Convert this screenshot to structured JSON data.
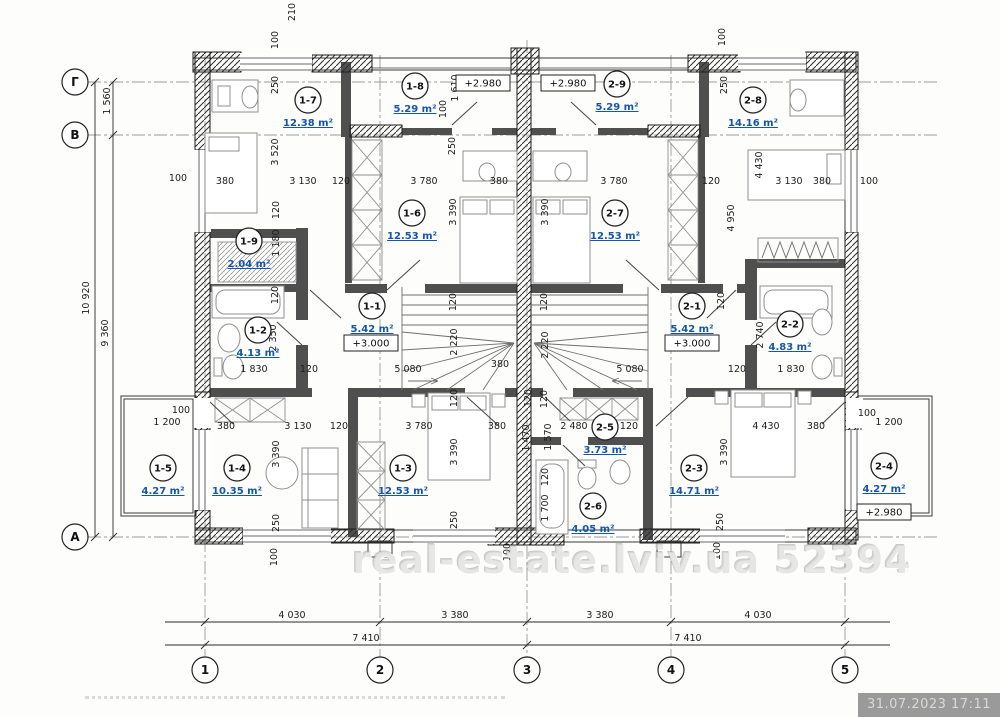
{
  "watermark": {
    "text": "real-estate.lviv.ua 52394"
  },
  "stamp": {
    "text": "31.07.2023 17:11"
  },
  "plan": {
    "rooms": [
      {
        "id": "1-7",
        "area": "12.38 m²",
        "x": 308,
        "y": 100
      },
      {
        "id": "1-8",
        "area": "5.29 m²",
        "x": 415,
        "y": 86
      },
      {
        "id": "2-9",
        "area": "5.29 m²",
        "x": 617,
        "y": 84
      },
      {
        "id": "2-8",
        "area": "14.16 m²",
        "x": 753,
        "y": 100
      },
      {
        "id": "1-6",
        "area": "12.53 m²",
        "x": 412,
        "y": 213
      },
      {
        "id": "2-7",
        "area": "12.53 m²",
        "x": 615,
        "y": 213
      },
      {
        "id": "1-9",
        "area": "2.04 m²",
        "x": 249,
        "y": 241
      },
      {
        "id": "1-2",
        "area": "4.13 m²",
        "x": 258,
        "y": 330
      },
      {
        "id": "1-1",
        "area": "5.42 m²",
        "x": 372,
        "y": 306
      },
      {
        "id": "2-1",
        "area": "5.42 m²",
        "x": 692,
        "y": 306
      },
      {
        "id": "2-2",
        "area": "4.83 m²",
        "x": 790,
        "y": 324
      },
      {
        "id": "1-5",
        "area": "4.27 m²",
        "x": 163,
        "y": 468
      },
      {
        "id": "1-4",
        "area": "10.35 m²",
        "x": 237,
        "y": 468
      },
      {
        "id": "1-3",
        "area": "12.53 m²",
        "x": 403,
        "y": 468
      },
      {
        "id": "2-5",
        "area": "3.73 m²",
        "x": 605,
        "y": 427
      },
      {
        "id": "2-6",
        "area": "4.05 m²",
        "x": 593,
        "y": 506
      },
      {
        "id": "2-3",
        "area": "14.71 m²",
        "x": 694,
        "y": 468
      },
      {
        "id": "2-4",
        "area": "4.27 m²",
        "x": 884,
        "y": 466
      }
    ],
    "elevations": [
      {
        "text": "+2.980",
        "x": 483,
        "y": 83
      },
      {
        "text": "+2.980",
        "x": 568,
        "y": 83
      },
      {
        "text": "+3.000",
        "x": 371,
        "y": 343
      },
      {
        "text": "+3.000",
        "x": 692,
        "y": 343
      },
      {
        "text": "+2.980",
        "x": 884,
        "y": 512
      }
    ],
    "axis_rows": [
      {
        "label": "Г",
        "y": 82
      },
      {
        "label": "В",
        "y": 135
      },
      {
        "label": "А",
        "y": 537
      }
    ],
    "axis_cols": [
      {
        "label": "1",
        "x": 205
      },
      {
        "label": "2",
        "x": 380
      },
      {
        "label": "3",
        "x": 527
      },
      {
        "label": "4",
        "x": 671
      },
      {
        "label": "5",
        "x": 845
      }
    ],
    "dims_h": [
      [
        "100",
        178,
        181
      ],
      [
        "380",
        225,
        184
      ],
      [
        "3 130",
        303,
        184
      ],
      [
        "120",
        341,
        184
      ],
      [
        "3 780",
        424,
        184
      ],
      [
        "380",
        499,
        184
      ],
      [
        "3 780",
        614,
        184
      ],
      [
        "120",
        711,
        184
      ],
      [
        "3 130",
        789,
        184
      ],
      [
        "380",
        822,
        184
      ],
      [
        "100",
        869,
        184
      ],
      [
        "1 830",
        254,
        372
      ],
      [
        "120",
        309,
        372
      ],
      [
        "5 080",
        408,
        372
      ],
      [
        "380",
        500,
        367
      ],
      [
        "5 080",
        630,
        372
      ],
      [
        "120",
        737,
        372
      ],
      [
        "1 830",
        791,
        372
      ],
      [
        "100",
        181,
        413
      ],
      [
        "1 200",
        167,
        425
      ],
      [
        "380",
        226,
        429
      ],
      [
        "3 130",
        298,
        429
      ],
      [
        "120",
        339,
        429
      ],
      [
        "3 780",
        419,
        429
      ],
      [
        "380",
        497,
        429
      ],
      [
        "2 480",
        574,
        429
      ],
      [
        "120",
        629,
        429
      ],
      [
        "4 430",
        766,
        429
      ],
      [
        "380",
        816,
        429
      ],
      [
        "100",
        867,
        416
      ],
      [
        "1 200",
        889,
        425
      ],
      [
        "4 030",
        292,
        618
      ],
      [
        "3 380",
        455,
        618
      ],
      [
        "3 380",
        600,
        618
      ],
      [
        "4 030",
        758,
        618
      ],
      [
        "7 410",
        366,
        641
      ],
      [
        "7 410",
        688,
        641
      ]
    ],
    "dims_v": [
      [
        "210",
        295,
        12
      ],
      [
        "100",
        278,
        40
      ],
      [
        "250",
        278,
        85
      ],
      [
        "3 520",
        278,
        152
      ],
      [
        "120",
        279,
        210
      ],
      [
        "1 180",
        279,
        243
      ],
      [
        "120",
        278,
        295
      ],
      [
        "2 350",
        276,
        338
      ],
      [
        "1 610",
        458,
        88
      ],
      [
        "100",
        446,
        109
      ],
      [
        "250",
        455,
        146
      ],
      [
        "3 390",
        456,
        212
      ],
      [
        "120",
        456,
        302
      ],
      [
        "2 220",
        457,
        342
      ],
      [
        "120",
        457,
        398
      ],
      [
        "3 390",
        457,
        452
      ],
      [
        "250",
        457,
        520
      ],
      [
        "100",
        725,
        37
      ],
      [
        "250",
        727,
        85
      ],
      [
        "4 950",
        734,
        218
      ],
      [
        "4 430",
        762,
        165
      ],
      [
        "3 390",
        548,
        212
      ],
      [
        "120",
        547,
        302
      ],
      [
        "2 220",
        548,
        345
      ],
      [
        "120",
        531,
        398
      ],
      [
        "1 470",
        529,
        438
      ],
      [
        "100",
        510,
        552
      ],
      [
        "120",
        547,
        399
      ],
      [
        "1 570",
        551,
        437
      ],
      [
        "120",
        548,
        477
      ],
      [
        "1 700",
        548,
        508
      ],
      [
        "2 740",
        763,
        335
      ],
      [
        "120",
        724,
        301
      ],
      [
        "3 390",
        727,
        452
      ],
      [
        "250",
        723,
        522
      ],
      [
        "100",
        720,
        551
      ],
      [
        "3 390",
        279,
        454
      ],
      [
        "250",
        279,
        523
      ],
      [
        "100",
        277,
        557
      ],
      [
        "1 560",
        110,
        101
      ],
      [
        "10 920",
        89,
        298
      ],
      [
        "9 360",
        108,
        333
      ]
    ]
  }
}
